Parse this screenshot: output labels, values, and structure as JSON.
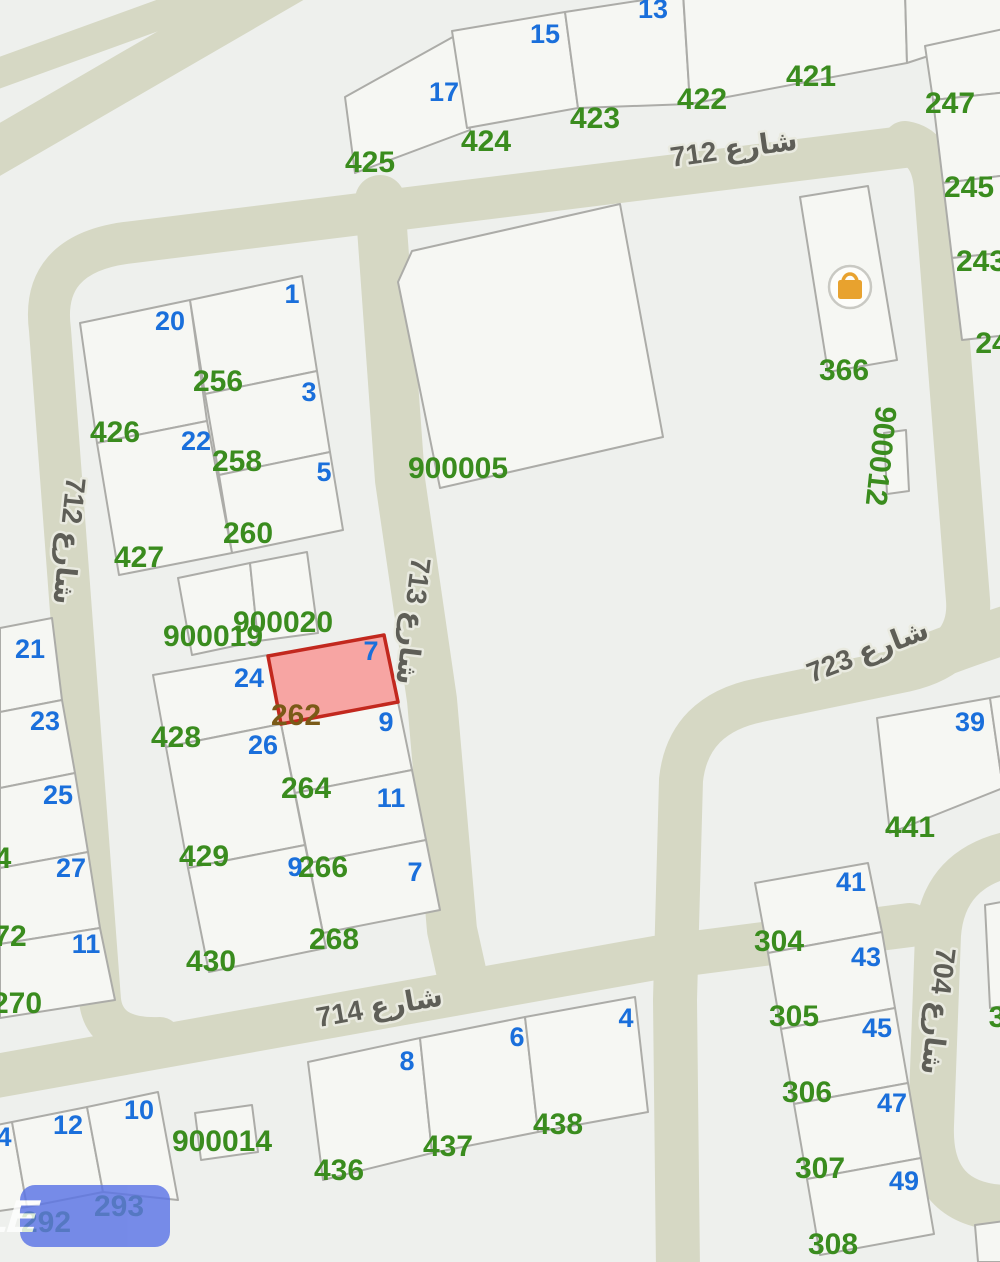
{
  "title": "parcel-map",
  "colors": {
    "background": "#eef0ed",
    "road": "#d6d8c4",
    "plot_fill": "#f6f7f3",
    "plot_border": "#acaca8",
    "house_number_blue": "#1a6fdb",
    "parcel_number_green": "#3a8c1e",
    "street_text": "#5e5e57",
    "selected_parcel_fill": "#f7a5a3",
    "selected_parcel_border": "#c2281e",
    "selected_parcel_number": "#7a5a17",
    "watermark_blue": "#5b74e6",
    "marker_orange": "#e8a22e"
  },
  "streets": [
    {
      "name": "شارع 712",
      "x": 735,
      "y": 158,
      "rotation": -8
    },
    {
      "name": "شارع 712",
      "x": 60,
      "y": 540,
      "rotation": 96
    },
    {
      "name": "شارع 713",
      "x": 404,
      "y": 620,
      "rotation": 97
    },
    {
      "name": "شارع 714",
      "x": 381,
      "y": 1016,
      "rotation": -10
    },
    {
      "name": "شارع 723",
      "x": 871,
      "y": 660,
      "rotation": -21
    },
    {
      "name": "شارع 704",
      "x": 929,
      "y": 1010,
      "rotation": 97
    }
  ],
  "selected_parcel": {
    "house_number": "7",
    "parcel_number": "262"
  },
  "house_numbers": [
    {
      "t": "13",
      "x": 653,
      "y": 18
    },
    {
      "t": "15",
      "x": 545,
      "y": 43
    },
    {
      "t": "17",
      "x": 444,
      "y": 101
    },
    {
      "t": "1",
      "x": 292,
      "y": 303
    },
    {
      "t": "20",
      "x": 170,
      "y": 330
    },
    {
      "t": "3",
      "x": 309,
      "y": 401
    },
    {
      "t": "22",
      "x": 196,
      "y": 450
    },
    {
      "t": "5",
      "x": 324,
      "y": 481
    },
    {
      "t": "21",
      "x": 30,
      "y": 658
    },
    {
      "t": "23",
      "x": 45,
      "y": 730
    },
    {
      "t": "25",
      "x": 58,
      "y": 804
    },
    {
      "t": "27",
      "x": 71,
      "y": 877
    },
    {
      "t": "11",
      "x": 86,
      "y": 953
    },
    {
      "t": "24",
      "x": 249,
      "y": 687
    },
    {
      "t": "7",
      "x": 371,
      "y": 660,
      "c": "sel-house"
    },
    {
      "t": "9",
      "x": 386,
      "y": 731
    },
    {
      "t": "26",
      "x": 263,
      "y": 754
    },
    {
      "t": "11",
      "x": 391,
      "y": 807
    },
    {
      "t": "9",
      "x": 295,
      "y": 876
    },
    {
      "t": "7",
      "x": 415,
      "y": 881
    },
    {
      "t": "8",
      "x": 407,
      "y": 1070
    },
    {
      "t": "6",
      "x": 517,
      "y": 1046
    },
    {
      "t": "4",
      "x": 626,
      "y": 1027
    },
    {
      "t": "12",
      "x": 68,
      "y": 1134
    },
    {
      "t": "10",
      "x": 139,
      "y": 1119
    },
    {
      "t": "4",
      "x": 4,
      "y": 1146
    },
    {
      "t": "39",
      "x": 970,
      "y": 731
    },
    {
      "t": "41",
      "x": 851,
      "y": 891
    },
    {
      "t": "43",
      "x": 866,
      "y": 966
    },
    {
      "t": "45",
      "x": 877,
      "y": 1037
    },
    {
      "t": "47",
      "x": 892,
      "y": 1112
    },
    {
      "t": "49",
      "x": 904,
      "y": 1190
    }
  ],
  "parcel_numbers": [
    {
      "t": "425",
      "x": 370,
      "y": 172
    },
    {
      "t": "424",
      "x": 486,
      "y": 151
    },
    {
      "t": "423",
      "x": 595,
      "y": 128
    },
    {
      "t": "422",
      "x": 702,
      "y": 109
    },
    {
      "t": "421",
      "x": 811,
      "y": 86
    },
    {
      "t": "247",
      "x": 950,
      "y": 113
    },
    {
      "t": "245",
      "x": 969,
      "y": 197
    },
    {
      "t": "243",
      "x": 981,
      "y": 271
    },
    {
      "t": "24",
      "x": 992,
      "y": 353
    },
    {
      "t": "366",
      "x": 844,
      "y": 380
    },
    {
      "t": "900012",
      "x": 871,
      "y": 455,
      "r": 96
    },
    {
      "t": "900005",
      "x": 458,
      "y": 478
    },
    {
      "t": "256",
      "x": 218,
      "y": 391
    },
    {
      "t": "258",
      "x": 237,
      "y": 471
    },
    {
      "t": "260",
      "x": 248,
      "y": 543
    },
    {
      "t": "426",
      "x": 115,
      "y": 442
    },
    {
      "t": "427",
      "x": 139,
      "y": 567
    },
    {
      "t": "900019",
      "x": 213,
      "y": 646
    },
    {
      "t": "900020",
      "x": 283,
      "y": 632
    },
    {
      "t": "262",
      "x": 296,
      "y": 725,
      "c": "pn-sel"
    },
    {
      "t": "428",
      "x": 176,
      "y": 747
    },
    {
      "t": "429",
      "x": 204,
      "y": 866
    },
    {
      "t": "430",
      "x": 211,
      "y": 971
    },
    {
      "t": "264",
      "x": 306,
      "y": 798
    },
    {
      "t": "266",
      "x": 323,
      "y": 877
    },
    {
      "t": "268",
      "x": 334,
      "y": 949
    },
    {
      "t": "270",
      "x": 17,
      "y": 1013
    },
    {
      "t": "72",
      "x": 10,
      "y": 946
    },
    {
      "t": "4",
      "x": 3,
      "y": 868
    },
    {
      "t": "436",
      "x": 339,
      "y": 1180
    },
    {
      "t": "437",
      "x": 448,
      "y": 1156
    },
    {
      "t": "438",
      "x": 558,
      "y": 1134
    },
    {
      "t": "900014",
      "x": 222,
      "y": 1151
    },
    {
      "t": "293",
      "x": 119,
      "y": 1216
    },
    {
      "t": "292",
      "x": 46,
      "y": 1232
    },
    {
      "t": "304",
      "x": 779,
      "y": 951
    },
    {
      "t": "305",
      "x": 794,
      "y": 1026
    },
    {
      "t": "306",
      "x": 807,
      "y": 1102
    },
    {
      "t": "307",
      "x": 820,
      "y": 1178
    },
    {
      "t": "308",
      "x": 833,
      "y": 1254
    },
    {
      "t": "441",
      "x": 910,
      "y": 837
    },
    {
      "t": "3",
      "x": 997,
      "y": 1027
    }
  ],
  "marker": {
    "icon": "shopping-bag"
  },
  "watermark": {
    "text": "4SALE"
  }
}
